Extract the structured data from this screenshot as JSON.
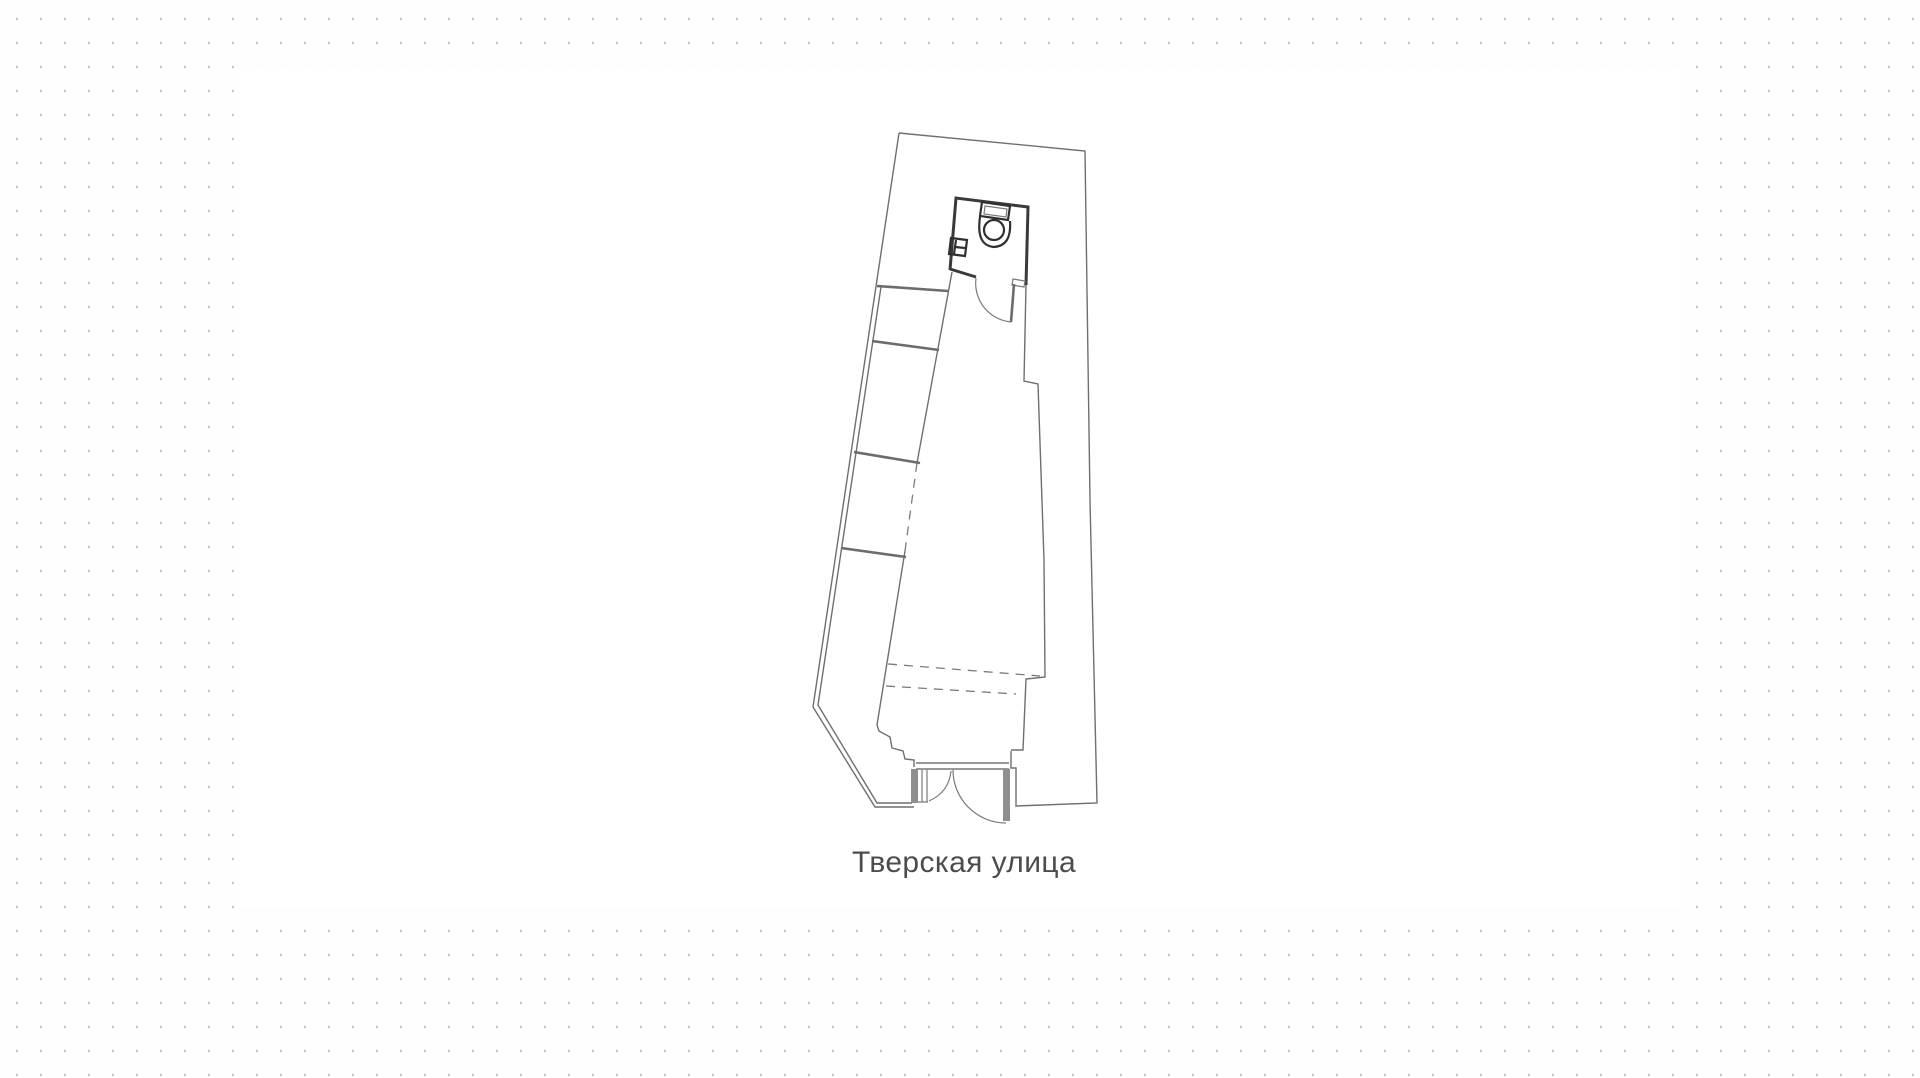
{
  "canvas": {
    "street_label": "Тверская улица"
  },
  "colors": {
    "page_background": "#fefefe",
    "dot_grid": "#c4c4c4",
    "card_background": "#ffffff",
    "outline_line": "#6f6f6f",
    "partition_line": "#6c6c6c",
    "plumbing_wall": "#3a3a3a",
    "door_leaf_fill": "#8f8f8f",
    "dashed_line": "#7a7a7a",
    "label_text": "#4c4c4e"
  },
  "icons": {
    "toilet": "toilet-icon",
    "sink": "sink-icon",
    "interior_door_swing": "door-swing-arc-icon",
    "entrance_door_swing": "entrance-door-arc-icon"
  }
}
